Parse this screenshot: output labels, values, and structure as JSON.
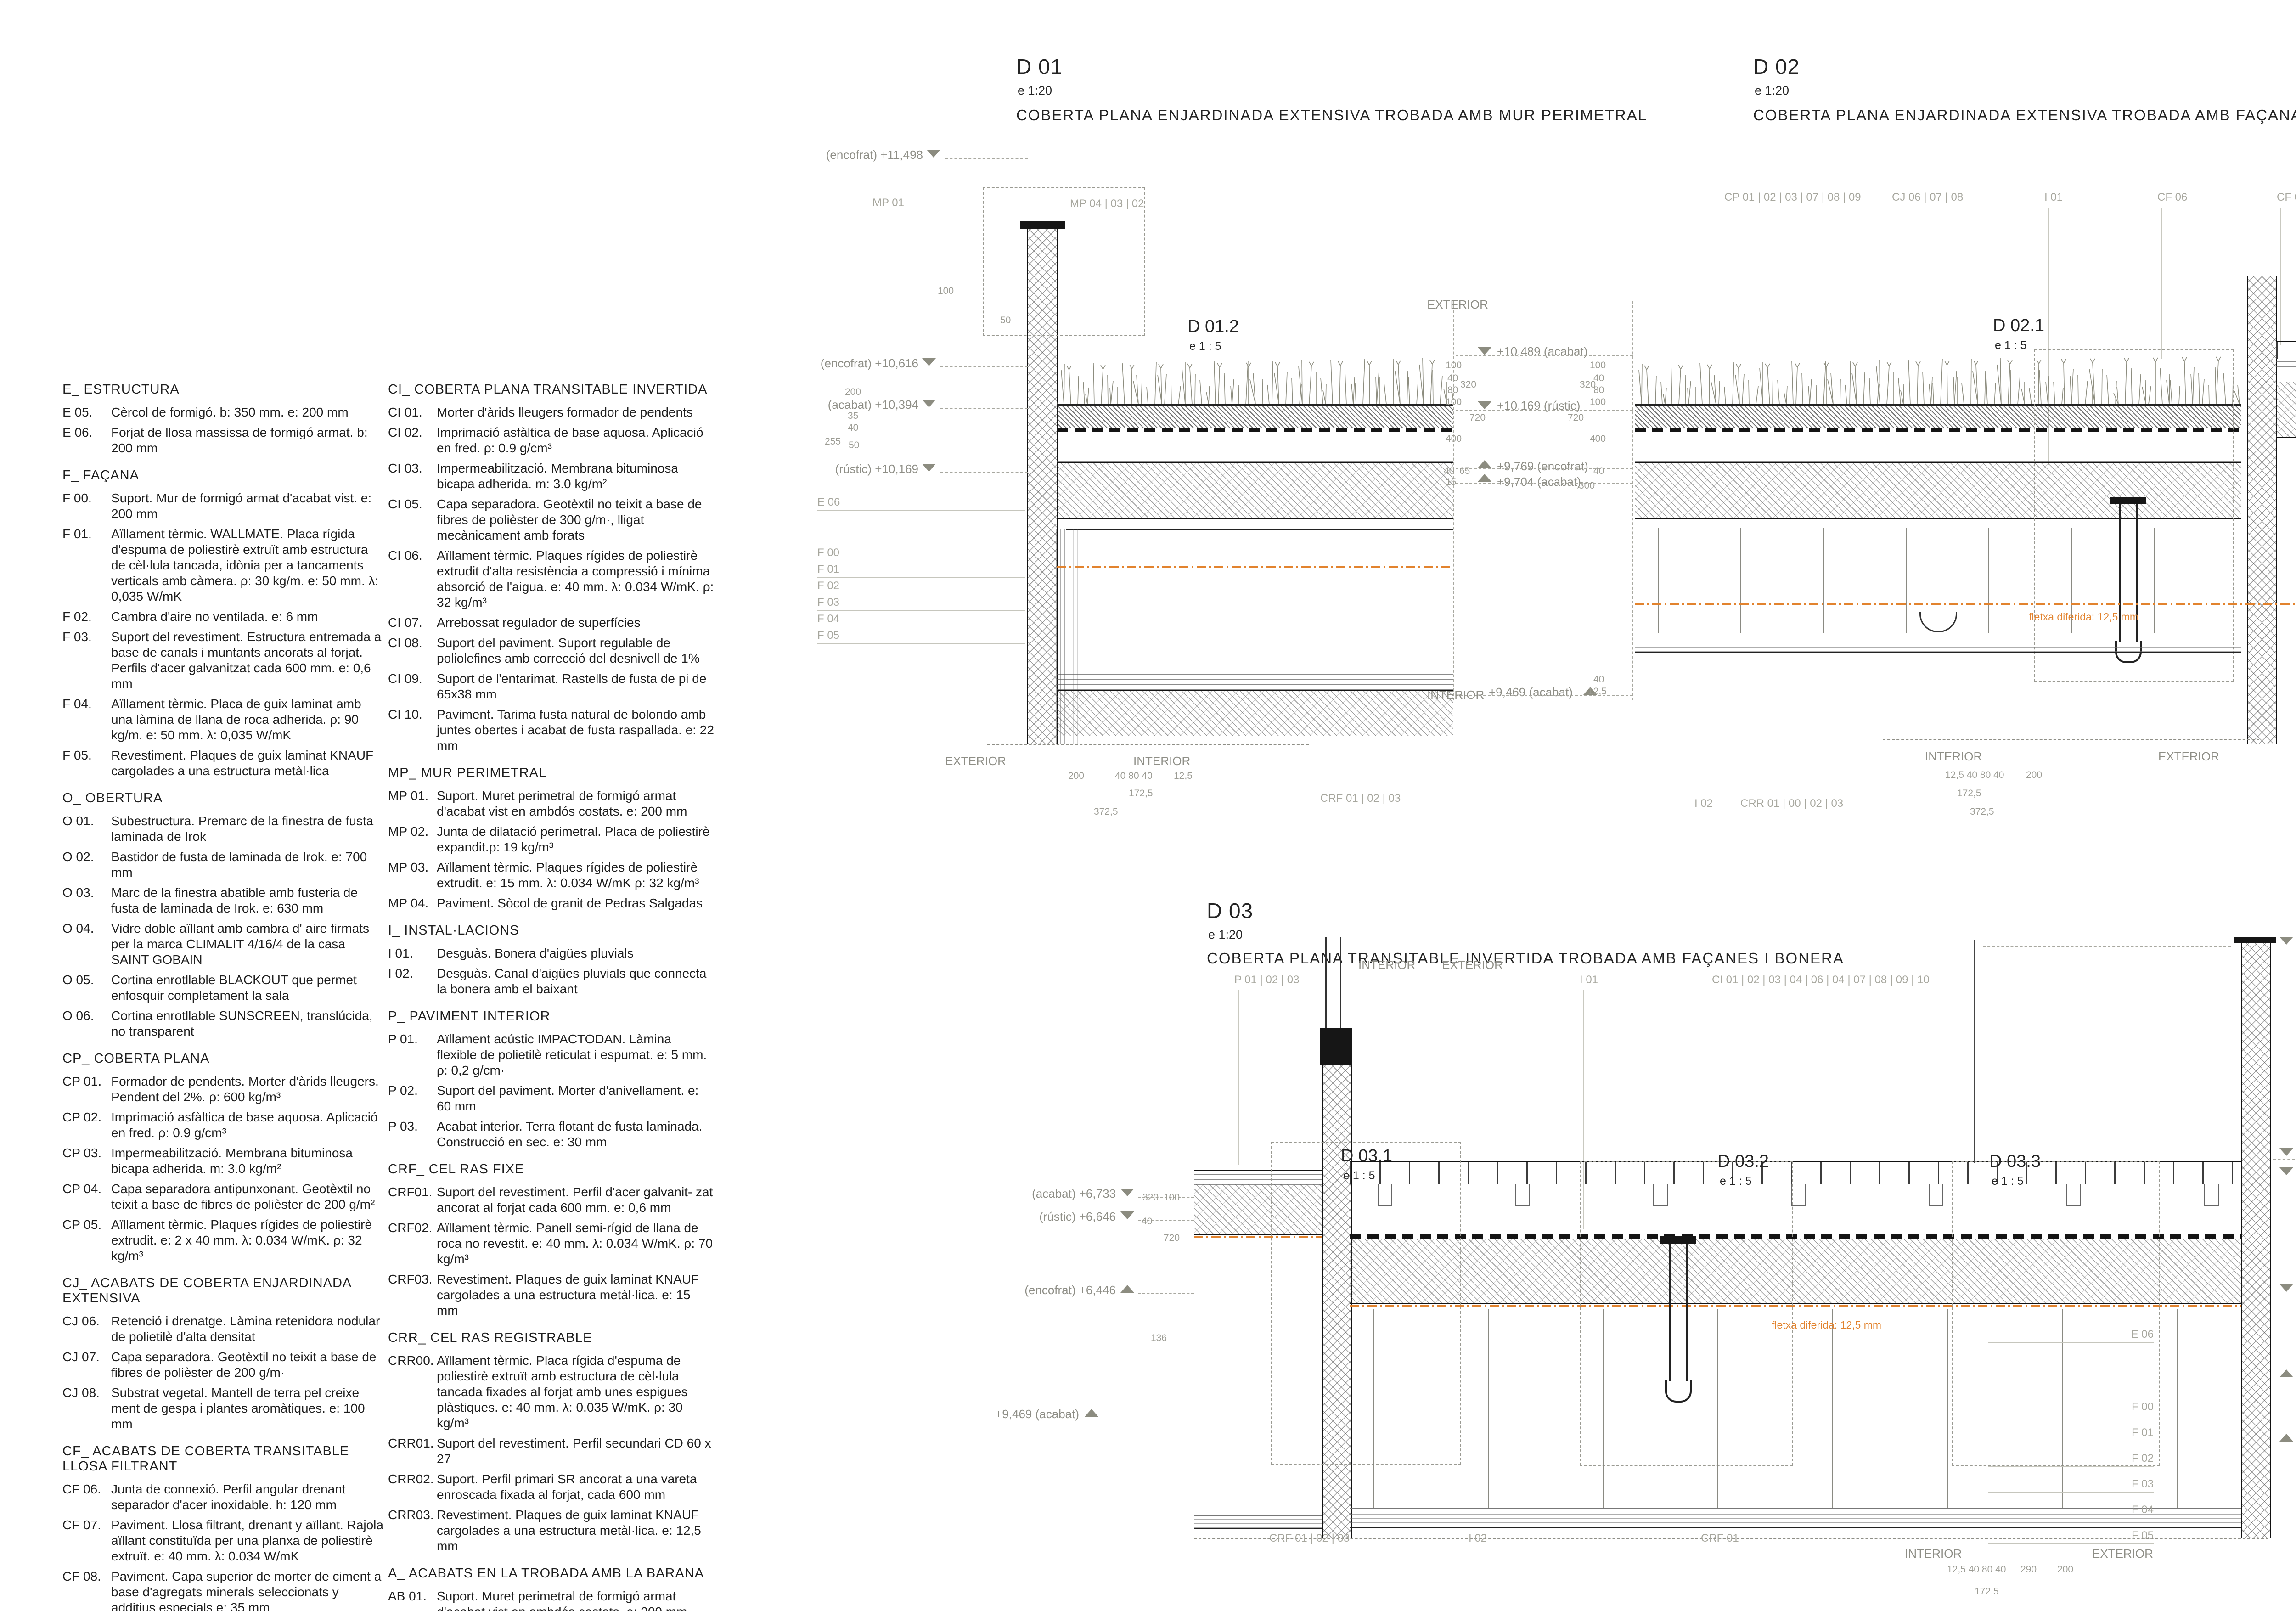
{
  "legend": {
    "col1": [
      {
        "title": "E_ ESTRUCTURA",
        "items": [
          {
            "tag": "E 05.",
            "text": "Cèrcol de formigó. b: 350 mm. e: 200 mm"
          },
          {
            "tag": "E 06.",
            "text": "Forjat de llosa massissa de formigó armat. b: 200 mm"
          }
        ]
      },
      {
        "title": "F_ FAÇANA",
        "items": [
          {
            "tag": "F 00.",
            "text": "Suport. Mur de formigó armat d'acabat vist. e: 200 mm"
          },
          {
            "tag": "F 01.",
            "text": "Aïllament tèrmic. WALLMATE. Placa rígida d'espuma de poliestirè extruït amb estructura de cèl·lula tancada, idònia per a tancaments verticals amb càmera. ρ: 30 kg/m. e: 50 mm. λ: 0,035 W/mK"
          },
          {
            "tag": "F 02.",
            "text": "Cambra d'aire no ventilada. e: 6 mm"
          },
          {
            "tag": "F 03.",
            "text": "Suport del revestiment. Estructura entremada a base de canals i muntants ancorats al forjat. Perfils d'acer galvanitzat cada 600 mm. e: 0,6 mm"
          },
          {
            "tag": "F 04.",
            "text": "Aïllament tèrmic. Placa de guix laminat amb una làmina de llana de roca adherida. ρ: 90 kg/m. e: 50 mm.  λ: 0,035 W/mK"
          },
          {
            "tag": "F 05.",
            "text": "Revestiment. Plaques de guix laminat KNAUF cargolades a una estructura metàl·lica"
          }
        ]
      },
      {
        "title": "O_ OBERTURA",
        "items": [
          {
            "tag": "O 01.",
            "text": "Subestructura. Premarc de la finestra de fusta laminada de Irok"
          },
          {
            "tag": "O 02.",
            "text": "Bastidor de fusta de laminada de Irok. e: 700 mm"
          },
          {
            "tag": "O 03.",
            "text": "Marc de la finestra abatible amb fusteria de fusta de laminada de Irok. e: 630 mm"
          },
          {
            "tag": "O 04.",
            "text": "Vidre doble aïllant amb cambra d' aire firmats per la marca CLIMALIT 4/16/4 de la casa SAINT GOBAIN"
          },
          {
            "tag": "O 05.",
            "text": "Cortina enrotllable BLACKOUT que permet enfosquir completament la sala"
          },
          {
            "tag": "O 06.",
            "text": "Cortina enrotllable SUNSCREEN, translúcida, no transparent"
          }
        ]
      },
      {
        "title": "CP_ COBERTA PLANA",
        "items": [
          {
            "tag": "CP 01.",
            "text": "Formador de pendents. Morter d'àrids lleugers. Pendent del 2%. ρ: 600 kg/m³"
          },
          {
            "tag": "CP 02.",
            "text": "Imprimació asfàltica de base aquosa. Aplicació en fred. ρ: 0.9 g/cm³"
          },
          {
            "tag": "CP 03.",
            "text": "Impermeabilització. Membrana bituminosa bicapa adherida. m: 3.0 kg/m²"
          },
          {
            "tag": "CP 04.",
            "text": "Capa separadora antipunxonant. Geotèxtil no teixit a base de fibres de polièster de 200 g/m²"
          },
          {
            "tag": "CP 05.",
            "text": "Aïllament tèrmic. Plaques rígides de poliestirè extrudit. e: 2 x 40 mm. λ: 0.034 W/mK. ρ: 32 kg/m³"
          }
        ]
      },
      {
        "title": "CJ_ ACABATS DE COBERTA ENJARDINADA EXTENSIVA",
        "items": [
          {
            "tag": "CJ 06.",
            "text": "Retenció i drenatge. Làmina retenidora nodular de polietilè d'alta densitat"
          },
          {
            "tag": "CJ 07.",
            "text": "Capa separadora. Geotèxtil no teixit a base de fibres de polièster de 200 g/m·"
          },
          {
            "tag": "CJ 08.",
            "text": "Substrat vegetal. Mantell de terra pel creixe ment de gespa i plantes aromàtiques. e: 100 mm"
          }
        ]
      },
      {
        "title": "CF_ ACABATS DE COBERTA TRANSITABLE LLOSA FILTRANT",
        "items": [
          {
            "tag": "CF 06.",
            "text": "Junta de connexió. Perfil angular drenant separador d'acer inoxidable. h: 120 mm"
          },
          {
            "tag": "CF 07.",
            "text": "Paviment. Llosa filtrant, drenant y aïllant. Rajola aïllant constituïda per una planxa de poliestirè extruït. e: 40 mm. λ: 0.034 W/mK"
          },
          {
            "tag": "CF 08.",
            "text": "Paviment. Capa superior de morter de ciment a base d'agregats minerals seleccionats y additius especials.e: 35 mm"
          }
        ]
      }
    ],
    "col2": [
      {
        "title": "CI_ COBERTA PLANA TRANSITABLE INVERTIDA",
        "items": [
          {
            "tag": "CI 01.",
            "text": "Morter d'àrids lleugers formador de pendents"
          },
          {
            "tag": "CI 02.",
            "text": "Imprimació asfàltica de base aquosa. Aplicació en fred. ρ: 0.9 g/cm³"
          },
          {
            "tag": "CI 03.",
            "text": "Impermeabilització. Membrana bituminosa bicapa adherida. m: 3.0 kg/m²"
          },
          {
            "tag": "CI 05.",
            "text": "Capa separadora. Geotèxtil no teixit a base de fibres de polièster de 300 g/m·, lligat mecànicament amb forats"
          },
          {
            "tag": "CI 06.",
            "text": "Aïllament tèrmic. Plaques rígides de poliestirè extrudit d'alta resistència a compressió i mínima absorció de l'aigua. e: 40 mm. λ: 0.034 W/mK. ρ: 32 kg/m³"
          },
          {
            "tag": "CI 07.",
            "text": "Arrebossat regulador de superfícies"
          },
          {
            "tag": "CI 08.",
            "text": "Suport del paviment. Suport regulable de poliolefines amb correcció del desnivell de 1%"
          },
          {
            "tag": "CI 09.",
            "text": "Suport de l'entarimat. Rastells de fusta de pi de 65x38 mm"
          },
          {
            "tag": "CI 10.",
            "text": "Paviment. Tarima fusta natural de bolondo amb juntes obertes i acabat de fusta raspallada. e: 22 mm"
          }
        ]
      },
      {
        "title": "MP_ MUR PERIMETRAL",
        "items": [
          {
            "tag": "MP 01.",
            "text": "Suport. Muret perimetral de formigó armat d'acabat vist en ambdós costats. e: 200 mm"
          },
          {
            "tag": "MP 02.",
            "text": "Junta de dilatació perimetral. Placa de poliestirè expandit.ρ: 19 kg/m³"
          },
          {
            "tag": "MP 03.",
            "text": "Aïllament tèrmic. Plaques rígides de poliestirè extrudit. e: 15 mm. λ: 0.034 W/mK ρ: 32 kg/m³"
          },
          {
            "tag": "MP 04.",
            "text": "Paviment. Sòcol de granit de Pedras Salgadas"
          }
        ]
      },
      {
        "title": "I_ INSTAL·LACIONS",
        "items": [
          {
            "tag": "I 01.",
            "text": "Desguàs. Bonera d'aigües pluvials"
          },
          {
            "tag": "I 02.",
            "text": "Desguàs. Canal d'aigües pluvials que connecta la bonera amb el baixant"
          }
        ]
      },
      {
        "title": "P_ PAVIMENT INTERIOR",
        "items": [
          {
            "tag": "P 01.",
            "text": "Aïllament acústic IMPACTODAN. Làmina flexible de polietilè reticulat i espumat. e: 5 mm. ρ: 0,2 g/cm·"
          },
          {
            "tag": "P 02.",
            "text": "Suport del paviment. Morter d'anivellament. e: 60 mm"
          },
          {
            "tag": "P 03.",
            "text": "Acabat interior. Terra flotant de fusta laminada. Construcció en sec. e: 30 mm"
          }
        ]
      },
      {
        "title": "CRF_ CEL RAS FIXE",
        "items": [
          {
            "tag": "CRF01.",
            "text": "Suport del revestiment. Perfil d'acer galvanit- zat ancorat al forjat cada 600 mm. e: 0,6 mm"
          },
          {
            "tag": "CRF02.",
            "text": "Aïllament tèrmic. Panell semi-rígid de llana de roca no revestit. e: 40 mm. λ: 0.034 W/mK. ρ: 70 kg/m³"
          },
          {
            "tag": "CRF03.",
            "text": "Revestiment. Plaques de guix laminat KNAUF cargolades a una estructura metàl·lica. e: 15 mm"
          }
        ]
      },
      {
        "title": "CRR_ CEL RAS REGISTRABLE",
        "items": [
          {
            "tag": "CRR00.",
            "text": "Aïllament tèrmic. Placa rígida d'espuma de poliestirè extruït amb estructura de cèl·lula tancada fixades al forjat amb unes espigues plàstiques. e: 40 mm. λ: 0.035 W/mK. ρ: 30 kg/m³"
          },
          {
            "tag": "CRR01.",
            "text": "Suport del revestiment. Perfil secundari CD 60 x 27"
          },
          {
            "tag": "CRR02.",
            "text": "Suport. Perfil primari SR ancorat a una vareta enroscada fixada al forjat, cada 600 mm"
          },
          {
            "tag": "CRR03.",
            "text": "Revestiment. Plaques de guix laminat KNAUF cargolades a una estructura metàl·lica. e: 12,5 mm"
          }
        ]
      },
      {
        "title": "A_ ACABATS EN LA TROBADA AMB LA BARANA",
        "items": [
          {
            "tag": "AB 01.",
            "text": "Suport. Muret perimetral de formigó armat d'acabat vist en ambdós costats. e: 200 mm"
          },
          {
            "tag": "AB 05.",
            "text": "Barana a base de perfils d'acer inoxidable."
          }
        ]
      }
    ]
  },
  "details": {
    "d01": {
      "code": "D 01",
      "scale": "e 1:20",
      "title": "COBERTA PLANA ENJARDINADA EXTENSIVA TROBADA AMB MUR PERIMETRAL"
    },
    "d02": {
      "code": "D 02",
      "scale": "e 1:20",
      "title": "COBERTA PLANA ENJARDINADA EXTENSIVA TROBADA AMB FAÇANA OPACA I BONERA"
    },
    "d03": {
      "code": "D 03",
      "scale": "e 1:20",
      "title": "COBERTA PLANA TRANSITABLE INVERTIDA TROBADA AMB FAÇANES I BONERA"
    },
    "subs": {
      "d012": "D 01.2",
      "d021": "D 02.1",
      "d031": "D 03.1",
      "d032": "D 03.2",
      "d033": "D 03.3",
      "scale": "e 1 : 5"
    }
  },
  "ann": {
    "lv_enc_11498": "(encofrat) +11,498",
    "lv_enc_10616": "(encofrat) +10,616",
    "lv_aca_10394": "(acabat)  +10,394",
    "lv_rus_10169": "(rústic) +10,169",
    "lv_aca_10489": "+10,489  (acabat)",
    "lv_rus_10169b": "+10,169  (rústic)",
    "lv_enc_9769": "+9,769  (encofrat)",
    "lv_aca_9704": "+9,704  (acabat)",
    "lv_aca_9469": "+9,469  (acabat)",
    "lv_aca_7833": "+7,833    (acabat)",
    "lv_aca_6733L": "(acabat)   +6,733",
    "lv_rus_6646": "(rústic)   +6,646",
    "lv_enc_6446": "(encofrat)   +6,446",
    "lv_aca_9469L": "+9,469   (acabat)",
    "lv_aca_6733": "+6,733    (acabat)",
    "lv_enc_6712": "+6,712    (encofrat)",
    "lv_rus_6306": "+6,306    (rústic)",
    "lv_enc_6106": "+6,106    (encofrat)",
    "lv_aca_5900": "+5,900    (acabat)",
    "tag_mp01": "MP 01",
    "tag_mp_row": "MP 04 | 03 | 02",
    "tag_e06": "E 06",
    "tag_f00": "F 00",
    "tag_f01": "F 01",
    "tag_f02": "F 02",
    "tag_f03": "F 03",
    "tag_f04": "F 04",
    "tag_f05": "F 05",
    "tag_crf_row": "CRF 01 | 02 | 03",
    "tag_crf01": "CRF 01",
    "tag_cp_row": "CP 01 | 02 | 03 | 07 | 08 | 09",
    "tag_cj_row": "CJ 06 | 07 | 08",
    "tag_i01": "I 01",
    "tag_cf06": "CF 06",
    "tag_cf_row": "CF 07 | 08",
    "tag_i02": "I 02",
    "tag_crr_row": "CRR 01 | 00 | 02 | 03",
    "tag_p_row": "P 01 | 02 | 03",
    "tag_ci_row": "CI 01 | 02 | 03 | 04 | 06 | 04 | 07 | 08 | 09 | 10",
    "word_ext": "EXTERIOR",
    "word_int": "INTERIOR",
    "note_fletxa": "fletxa diferida: 12,5 mm",
    "d100": "100",
    "d200": "200",
    "d255": "255",
    "d300": "300",
    "d320": "320",
    "d400": "400",
    "d720": "720",
    "d35": "35",
    "d40": "40",
    "d50": "50",
    "d65": "65",
    "d80": "80",
    "d15": "15",
    "d136": "136",
    "d290": "290",
    "d125": "12,5",
    "d1725": "172,5",
    "d3725": "372,5",
    "chain": "12,5  40  80  40",
    "chain2": "40  80  40"
  }
}
